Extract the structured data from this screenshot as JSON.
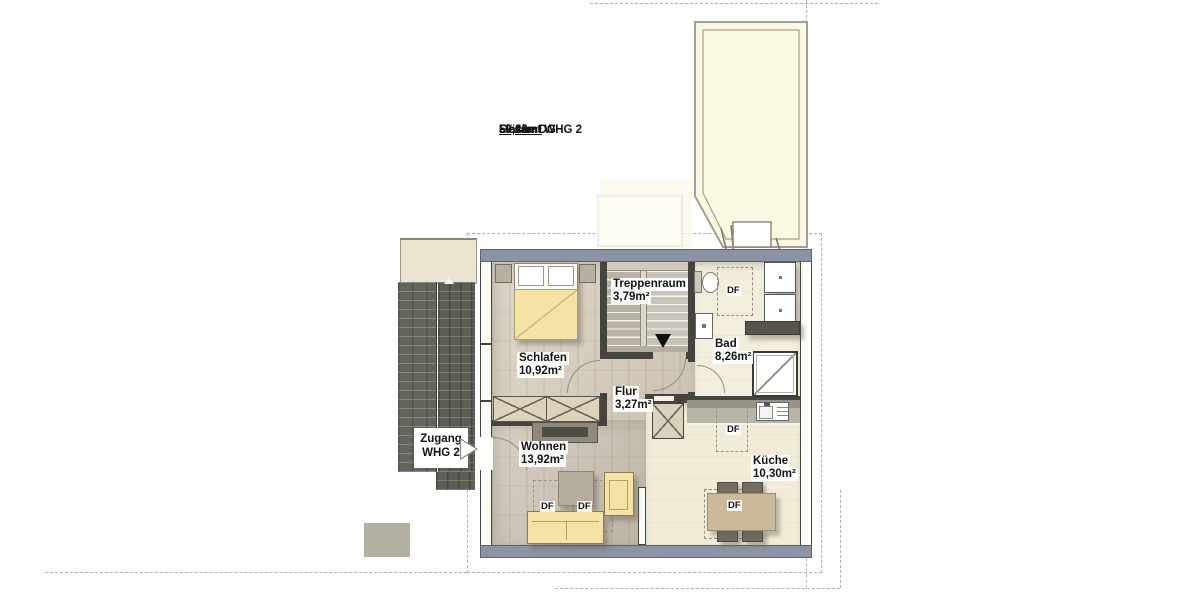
{
  "annotations": {
    "flaeche_label": "Fläche DG",
    "flaeche_value": "50,26m²",
    "gesamt_label": "Gesamt WHG 2",
    "gesamt_value": "50,46m²"
  },
  "entrance": {
    "line1": "Zugang",
    "line2": "WHG 2"
  },
  "rooms": {
    "schlafen": {
      "name": "Schlafen",
      "area": "10,92m²"
    },
    "treppenraum": {
      "name": "Treppenraum",
      "area": "3,79m²"
    },
    "bad": {
      "name": "Bad",
      "area": "8,26m²"
    },
    "flur": {
      "name": "Flur",
      "area": "3,27m²"
    },
    "wohnen": {
      "name": "Wohnen",
      "area": "13,92m²"
    },
    "kueche": {
      "name": "Küche",
      "area": "10,30m²"
    }
  },
  "labels": {
    "roof_window": "DF"
  },
  "colors": {
    "wall_slate": "#8b94a4",
    "roof_dark": "#64635c",
    "gable_fill": "#faf8e2",
    "floor_wood": "#d3c9b7",
    "floor_tile": "#f2eedb",
    "furniture_yellow": "#f4e3a4"
  }
}
